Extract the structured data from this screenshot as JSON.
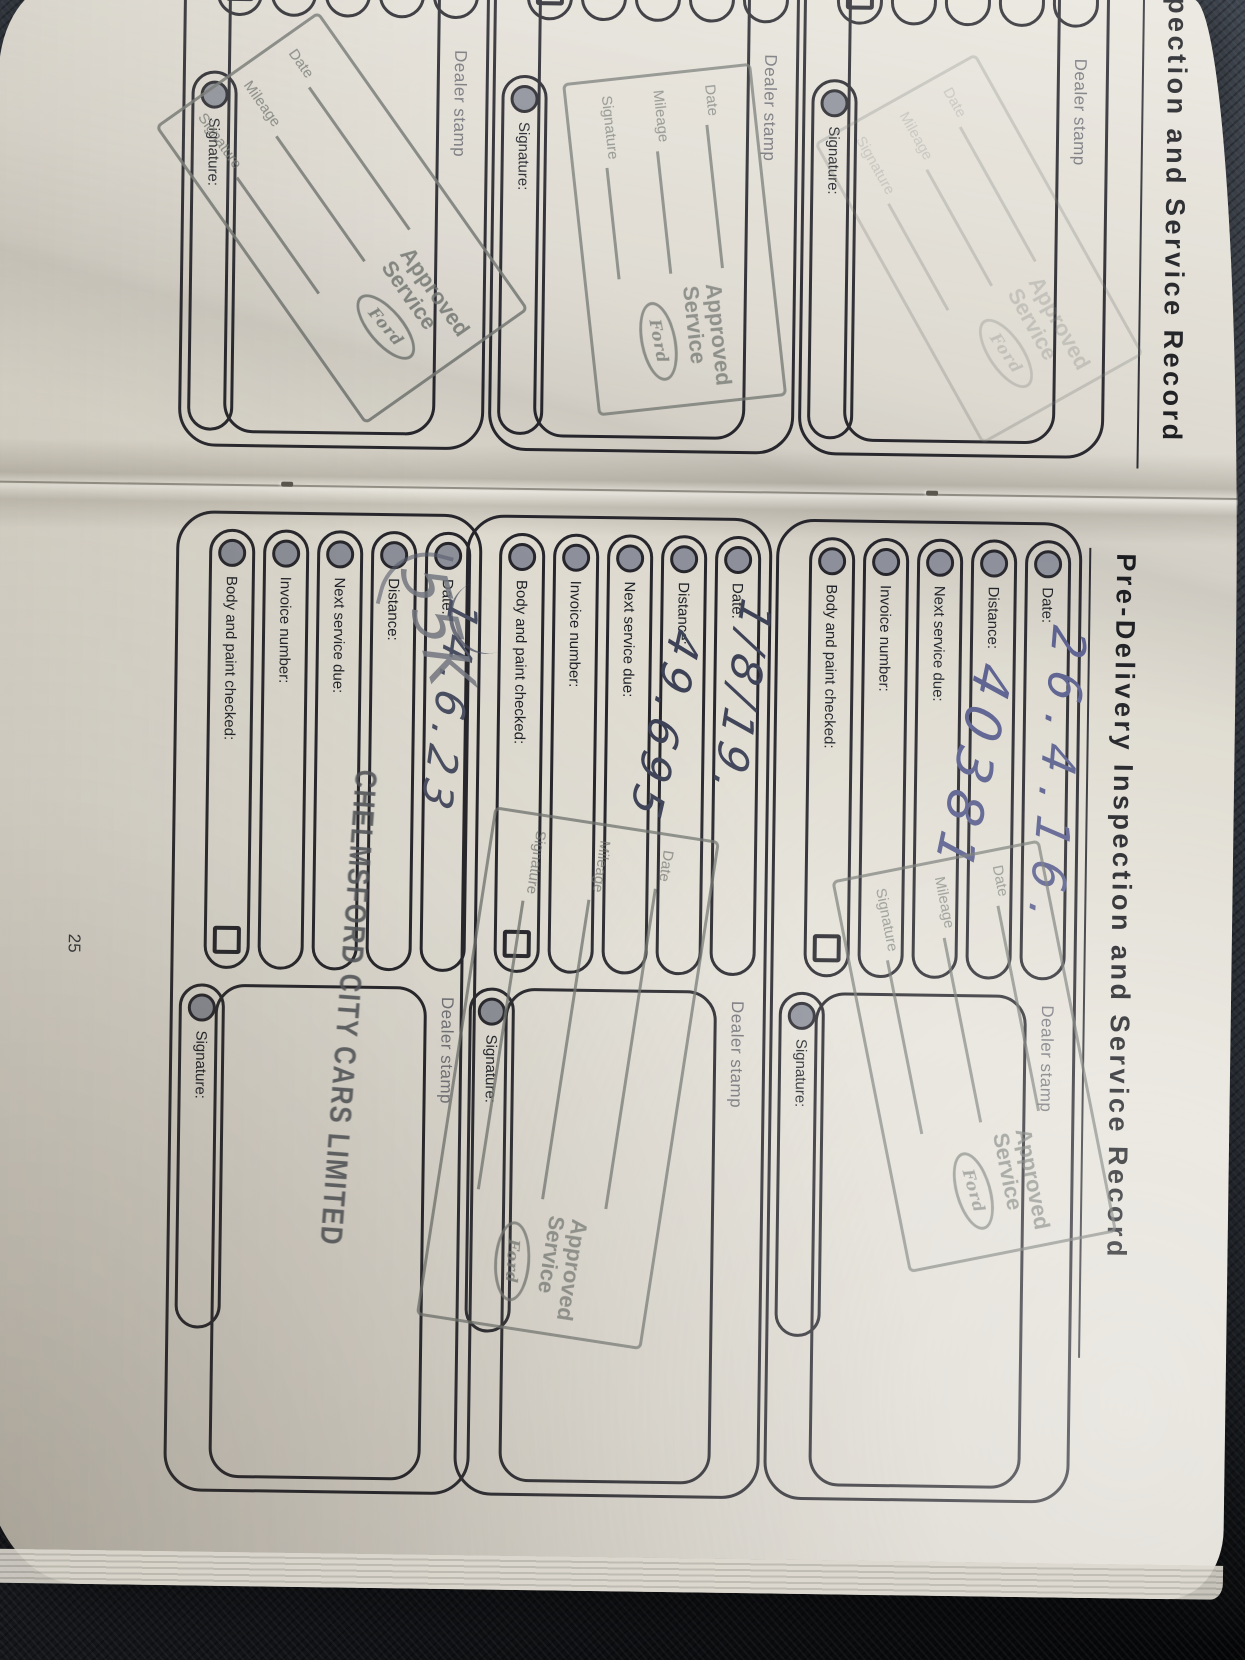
{
  "background": {
    "fabric_color": "#2f343b",
    "shadow_color": "#060708"
  },
  "book": {
    "paper_color": "#ded9cf",
    "ink_color": "#575c8c",
    "stamp_color": "#70746f",
    "left_page": {
      "header_fragment": "pection and Service Record",
      "dealer_stamp_label": "Dealer stamp",
      "signature_label": "Signature:"
    },
    "right_page": {
      "header": "Pre-Delivery Inspection and Service Record",
      "page_number": "25",
      "field_labels": [
        "Date:",
        "Distance:",
        "Next service due:",
        "Invoice number:",
        "Body and paint checked:"
      ],
      "signature_label": "Signature:",
      "dealer_stamp_label": "Dealer stamp",
      "boxes": [
        {
          "date_value": "26.4.16.",
          "distance_value": "40381"
        },
        {
          "date_value": "1/8/19.",
          "distance_value": "49.695"
        },
        {
          "date_value": "14.6.23",
          "distance_value": "55K"
        }
      ]
    },
    "approved_stamp": {
      "word1": "Approved",
      "word2": "Service",
      "brand": "Ford",
      "rows": [
        "Date",
        "Mileage",
        "Signature"
      ]
    },
    "dealer_name_stamp": "CHELMSFORD CITY CARS LIMITED"
  }
}
